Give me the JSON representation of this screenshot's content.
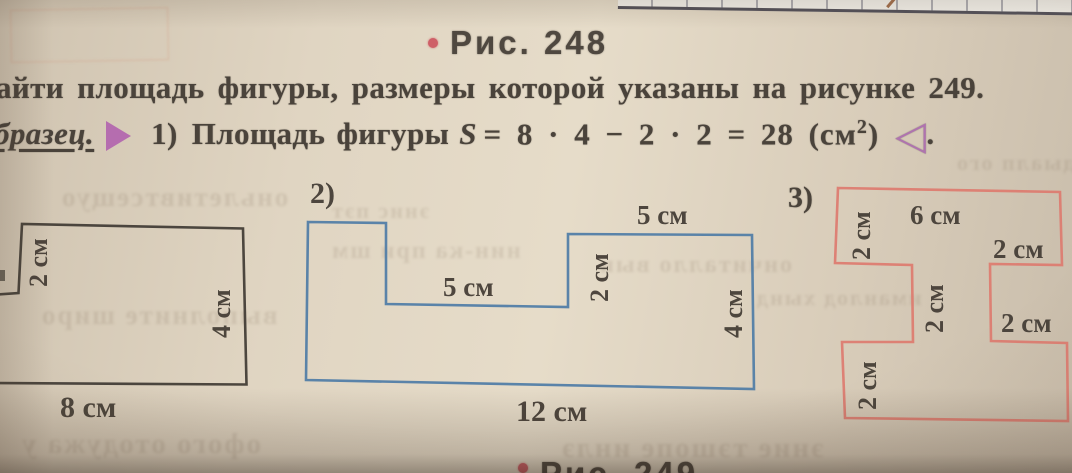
{
  "captions": {
    "top": "Рис. 248",
    "bottom": "Рис. 249"
  },
  "text": {
    "line1": "айти площадь фигуры, размеры которой указаны на рисунке 249.",
    "sample_label": "бразец.",
    "item1_prefix": "1)",
    "item1_text": "Площадь фигуры",
    "formula_var": "S",
    "formula_mid": "= 8 · 4 − 2 · 2 = 28 (см",
    "formula_sup": "2",
    "formula_close": ")",
    "end_marker": "◁",
    "end_period": "."
  },
  "figures": {
    "fig1": {
      "labels": {
        "notch_height": "2 см",
        "right_side": "4 см",
        "bottom": "8 см"
      }
    },
    "fig2": {
      "number": "2)",
      "labels": {
        "top_right_width": "5 см",
        "middle_width": "5 см",
        "step_height": "2 см",
        "right_side": "4 см",
        "bottom": "12 см"
      }
    },
    "fig3": {
      "number": "3)",
      "labels": {
        "top_bar_height": "2 см",
        "top_width": "6 см",
        "right_overhang": "2 см",
        "column_width": "2 см",
        "right_notch": "2 см",
        "bottom_bar_height": "2 см"
      }
    }
  },
  "colors": {
    "paper": "#ddd2c0",
    "text": "#4a433b",
    "figure1_stroke": "#3f3933",
    "figure2_stroke": "#4e7ca6",
    "figure3_stroke": "#dd7b6f",
    "accent_purple": "#b163ae",
    "bullet_red": "#cb4a57"
  },
  "ghost_lines": {
    "l1": "оньлетивтсещуо",
    "l2": "нин-ка при шм",
    "l3": "ончиталло вын",
    "l4": "выполните широ",
    "l5": "офого отодужа у",
    "l6": "эние тэшопе инлэ",
    "l7": "иманлод хынд",
    "l8": "тыдыалп ого",
    "l9": "энис пэт"
  }
}
